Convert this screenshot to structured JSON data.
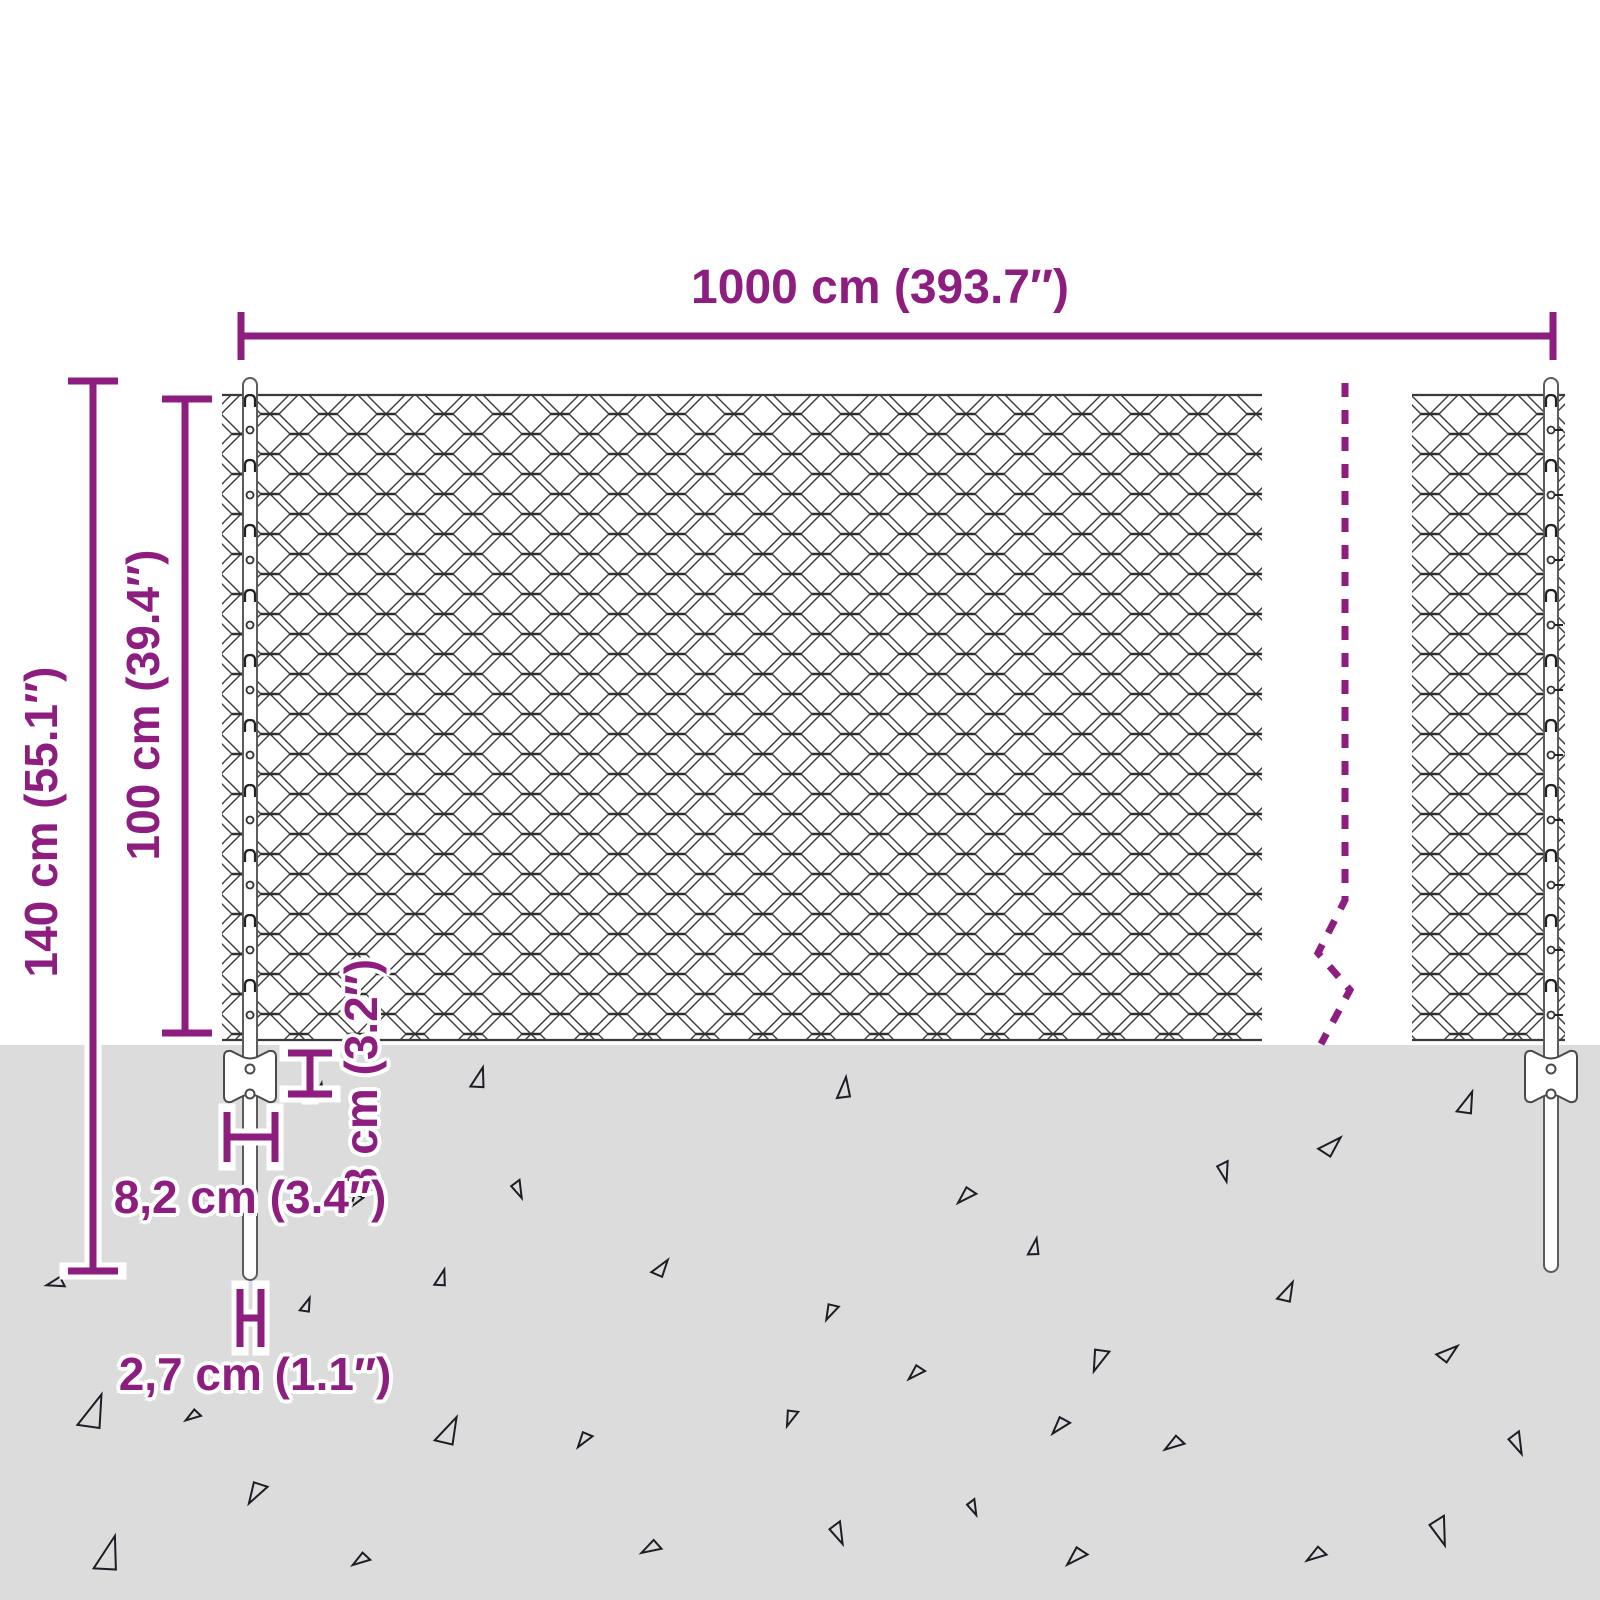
{
  "colors": {
    "accent": "#8e1d80",
    "ground": "#dcdcdc",
    "line": "#3a3a3a",
    "halo": "#ffffff"
  },
  "dimensions": {
    "width": {
      "label": "1000 cm (393.7″)"
    },
    "total_height": {
      "label": "140 cm (55.1″)"
    },
    "fence_height": {
      "label": "100 cm (39.4″)"
    },
    "anchor_depth": {
      "label": "8 cm (3.2″)"
    },
    "anchor_width": {
      "label": "8,2 cm (3.4″)"
    },
    "post_diameter": {
      "label": "2,7 cm (1.1″)"
    }
  },
  "ground": {
    "triangles": [
      {
        "x": 480,
        "y": 1078,
        "s": 20,
        "r": 10
      },
      {
        "x": 845,
        "y": 1088,
        "s": 20,
        "r": 0
      },
      {
        "x": 1468,
        "y": 1103,
        "s": 22,
        "r": 15
      },
      {
        "x": 320,
        "y": 1092,
        "s": 16,
        "r": 5
      },
      {
        "x": 1332,
        "y": 1146,
        "s": 22,
        "r": 40
      },
      {
        "x": 1224,
        "y": 1172,
        "s": 18,
        "r": 160
      },
      {
        "x": 518,
        "y": 1190,
        "s": 16,
        "r": 150
      },
      {
        "x": 965,
        "y": 1196,
        "s": 18,
        "r": 220
      },
      {
        "x": 355,
        "y": 1201,
        "s": 14,
        "r": 210
      },
      {
        "x": 55,
        "y": 1283,
        "s": 16,
        "r": 250
      },
      {
        "x": 662,
        "y": 1268,
        "s": 18,
        "r": 30
      },
      {
        "x": 1035,
        "y": 1247,
        "s": 16,
        "r": 5
      },
      {
        "x": 442,
        "y": 1278,
        "s": 16,
        "r": 10
      },
      {
        "x": 830,
        "y": 1312,
        "s": 16,
        "r": 200
      },
      {
        "x": 1288,
        "y": 1292,
        "s": 20,
        "r": 20
      },
      {
        "x": 307,
        "y": 1305,
        "s": 14,
        "r": 15
      },
      {
        "x": 1098,
        "y": 1360,
        "s": 22,
        "r": 195
      },
      {
        "x": 915,
        "y": 1373,
        "s": 16,
        "r": 220
      },
      {
        "x": 1449,
        "y": 1353,
        "s": 20,
        "r": 45
      },
      {
        "x": 95,
        "y": 1412,
        "s": 34,
        "r": 15
      },
      {
        "x": 192,
        "y": 1416,
        "s": 14,
        "r": 230
      },
      {
        "x": 1059,
        "y": 1426,
        "s": 18,
        "r": 215
      },
      {
        "x": 450,
        "y": 1431,
        "s": 28,
        "r": 20
      },
      {
        "x": 583,
        "y": 1440,
        "s": 16,
        "r": 210
      },
      {
        "x": 790,
        "y": 1418,
        "s": 16,
        "r": 195
      },
      {
        "x": 1173,
        "y": 1444,
        "s": 18,
        "r": 230
      },
      {
        "x": 1517,
        "y": 1444,
        "s": 20,
        "r": 150
      },
      {
        "x": 255,
        "y": 1493,
        "s": 22,
        "r": 205
      },
      {
        "x": 110,
        "y": 1554,
        "s": 34,
        "r": 10
      },
      {
        "x": 360,
        "y": 1560,
        "s": 16,
        "r": 230
      },
      {
        "x": 650,
        "y": 1548,
        "s": 18,
        "r": 235
      },
      {
        "x": 838,
        "y": 1534,
        "s": 20,
        "r": 150
      },
      {
        "x": 973,
        "y": 1508,
        "s": 14,
        "r": 150
      },
      {
        "x": 1075,
        "y": 1557,
        "s": 20,
        "r": 220
      },
      {
        "x": 1440,
        "y": 1532,
        "s": 26,
        "r": 155
      },
      {
        "x": 1315,
        "y": 1555,
        "s": 18,
        "r": 230
      }
    ]
  }
}
